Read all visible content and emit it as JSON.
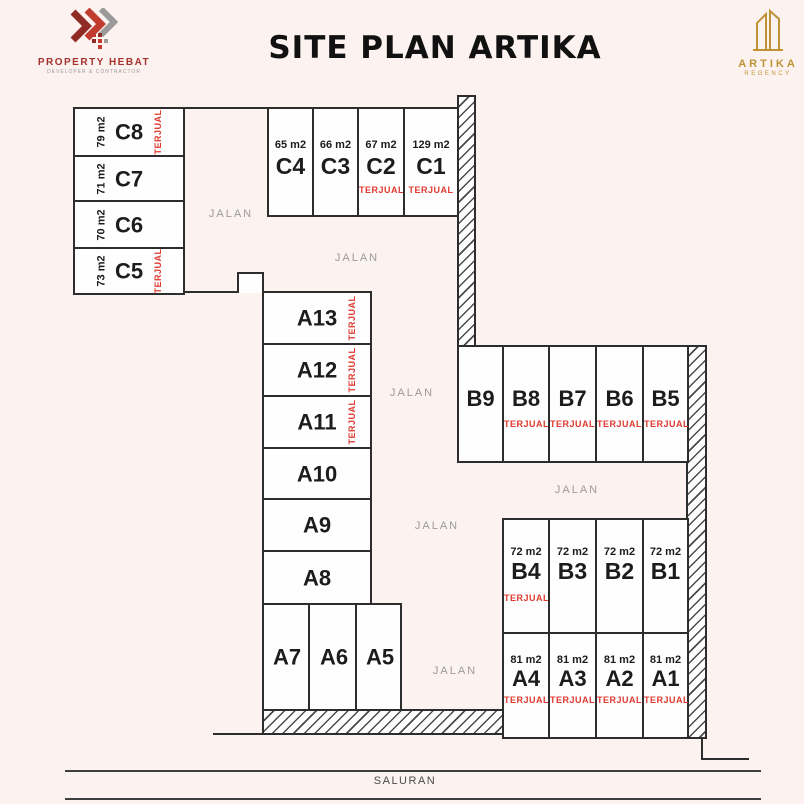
{
  "header": {
    "brand_left": {
      "name": "PROPERTY HEBAT",
      "tagline": "DEVELOPER & CONTRACTOR"
    },
    "title": "SITE PLAN ARTIKA",
    "brand_right": {
      "name": "ARTIKA",
      "subname": "REGENCY"
    }
  },
  "icons": {
    "brand_left": "double-chevron-pixel-icon",
    "brand_right": "gold-towers-icon"
  },
  "labels": {
    "road": "JALAN",
    "channel": "SALURAN",
    "sold": "TERJUAL"
  },
  "colors": {
    "background": "#fcf2f0",
    "line": "#2d2d2d",
    "sold_red": "#e03a30",
    "brand_red": "#a5322c",
    "brand_gold": "#bf9335",
    "road_label_gray": "#9b9b9b"
  },
  "lots": {
    "c_left": [
      {
        "id": "C8",
        "size": "79 m2",
        "sold": "TERJUAL"
      },
      {
        "id": "C7",
        "size": "71 m2",
        "sold": ""
      },
      {
        "id": "C6",
        "size": "70 m2",
        "sold": ""
      },
      {
        "id": "C5",
        "size": "73 m2",
        "sold": "TERJUAL"
      }
    ],
    "c_top": [
      {
        "id": "C4",
        "size": "65 m2",
        "sold": ""
      },
      {
        "id": "C3",
        "size": "66 m2",
        "sold": ""
      },
      {
        "id": "C2",
        "size": "67 m2",
        "sold": "TERJUAL"
      },
      {
        "id": "C1",
        "size": "129 m2",
        "sold": "TERJUAL"
      }
    ],
    "a_column": [
      {
        "id": "A13",
        "sold": "TERJUAL"
      },
      {
        "id": "A12",
        "sold": "TERJUAL"
      },
      {
        "id": "A11",
        "sold": "TERJUAL"
      },
      {
        "id": "A10",
        "sold": ""
      },
      {
        "id": "A9",
        "sold": ""
      },
      {
        "id": "A8",
        "sold": ""
      }
    ],
    "a_bottom": [
      {
        "id": "A7"
      },
      {
        "id": "A6"
      },
      {
        "id": "A5"
      }
    ],
    "b_upper": [
      {
        "id": "B9",
        "sold": ""
      },
      {
        "id": "B8",
        "sold": "TERJUAL"
      },
      {
        "id": "B7",
        "sold": "TERJUAL"
      },
      {
        "id": "B6",
        "sold": "TERJUAL"
      },
      {
        "id": "B5",
        "sold": "TERJUAL"
      }
    ],
    "b_lower": [
      {
        "id": "B4",
        "size": "72 m2",
        "sold": "TERJUAL"
      },
      {
        "id": "B3",
        "size": "72 m2",
        "sold": ""
      },
      {
        "id": "B2",
        "size": "72 m2",
        "sold": ""
      },
      {
        "id": "B1",
        "size": "72 m2",
        "sold": ""
      }
    ],
    "a_row": [
      {
        "id": "A4",
        "size": "81 m2",
        "sold": "TERJUAL"
      },
      {
        "id": "A3",
        "size": "81 m2",
        "sold": "TERJUAL"
      },
      {
        "id": "A2",
        "size": "81 m2",
        "sold": "TERJUAL"
      },
      {
        "id": "A1",
        "size": "81 m2",
        "sold": "TERJUAL"
      }
    ]
  }
}
